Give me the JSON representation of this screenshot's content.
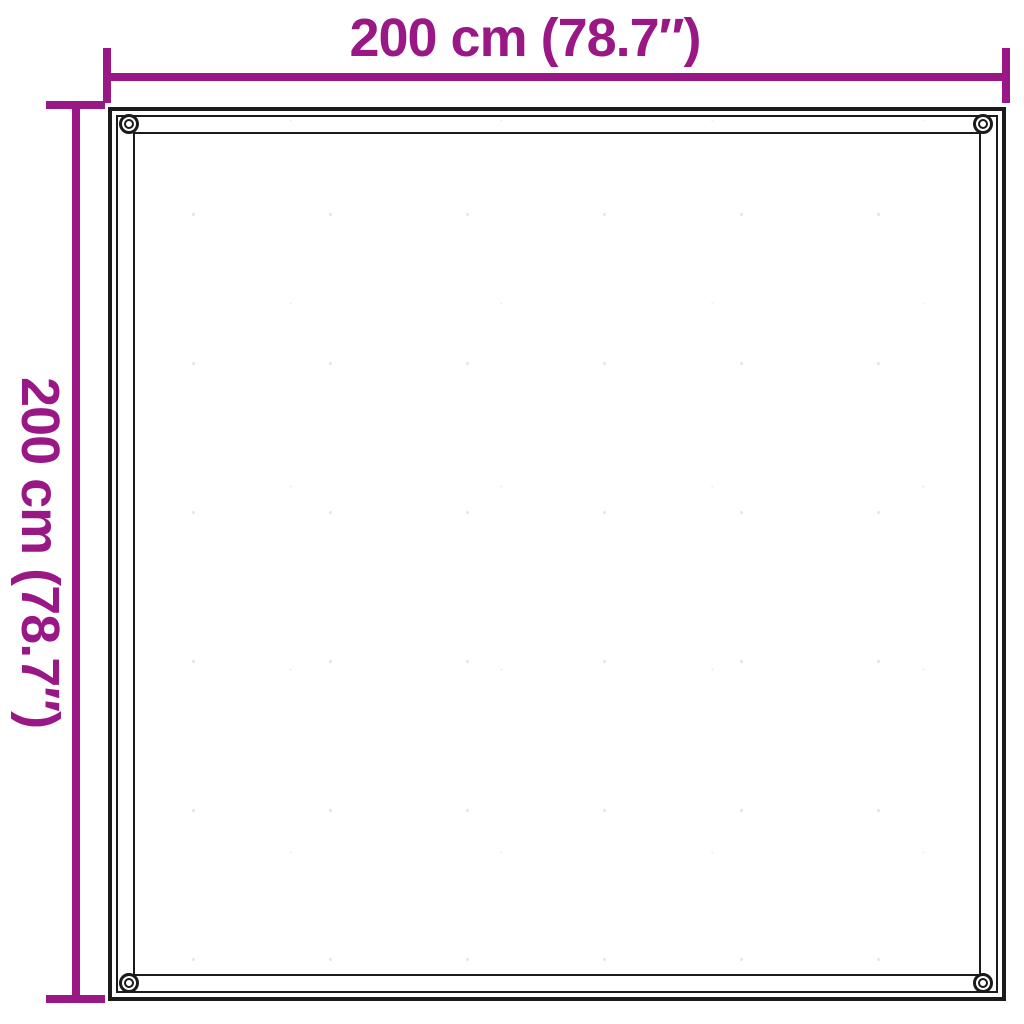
{
  "colors": {
    "background": "#FFFFFF",
    "outline": "#1B1B1B",
    "accent": "#991885"
  },
  "dimensions": {
    "width": {
      "label": "200 cm (78.7″)"
    },
    "height": {
      "label": "200 cm (78.7″)"
    }
  },
  "sheet": {
    "eyelet_count": 4,
    "eyelet_positions": [
      "top-left",
      "top-right",
      "bottom-left",
      "bottom-right"
    ]
  }
}
